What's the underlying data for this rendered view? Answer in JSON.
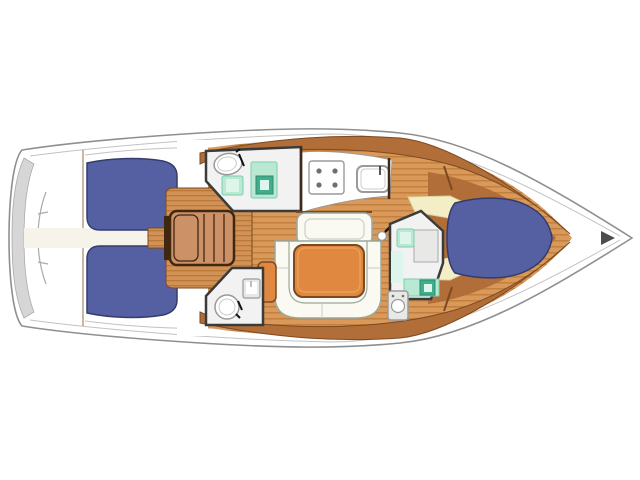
{
  "vessel": {
    "type": "sailing yacht monohull",
    "view": "overhead deck and interior layout plan",
    "orientation": "bow to the right, stern (transom) to the left",
    "background": "plain white, no text or labels rendered"
  },
  "features": [
    {
      "id": "swim-platform",
      "label": "Rounded transom with swim platform steps"
    },
    {
      "id": "cockpit-walkway",
      "label": "Center walkway from transom into cockpit"
    },
    {
      "id": "cockpit-bench-upper",
      "label": "Cockpit bench with blue cushion (upper side)"
    },
    {
      "id": "cockpit-bench-lower",
      "label": "Cockpit bench with blue cushion (lower side)"
    },
    {
      "id": "cockpit-sole",
      "label": "Teak-planked cockpit sole"
    },
    {
      "id": "companionway-steps",
      "label": "Companionway steps down to saloon",
      "treads": 4
    },
    {
      "id": "aft-head-upper",
      "label": "Aft head: toilet, mint sink and shower stall"
    },
    {
      "id": "aft-head-lower",
      "label": "Second aft head: toilet and sink"
    },
    {
      "id": "galley",
      "label": "Galley with stove and sink",
      "burners": 4
    },
    {
      "id": "saloon",
      "label": "Saloon: straight bench, U-shaped settee and wood table"
    },
    {
      "id": "mast-post",
      "label": "Mast compression post beside settee"
    },
    {
      "id": "forward-head",
      "label": "Forward head: mint sink, counter unit and toilet"
    },
    {
      "id": "v-berth",
      "label": "Forward cabin V-berth with blue mattress"
    },
    {
      "id": "bow-fitting",
      "label": "Bow anchor fitting (dark triangle at stem)"
    }
  ],
  "colors": {
    "white": "#ffffff",
    "hull_stroke": "#8f8f8f",
    "sheer_line": "#c2c2c2",
    "transom_gray": "#d6d6d6",
    "transom_line": "#aaaaaa",
    "cushion_blue": "#5560a3",
    "cushion_blue_dark": "#343c6b",
    "plank_base": "#d9995b",
    "plank_line": "#c2803c",
    "teak_base": "#d29257",
    "teak_line": "#b97a38",
    "wood_band": "#b26e38",
    "wood_band_edge": "#7c4a22",
    "wood_dark_line": "#3f2a16",
    "steps_fill": "#cd9168",
    "steps_edge": "#40270f",
    "room_floor": "#f2f2f2",
    "room_wall": "#3b3b3b",
    "mint": "#b9e9d3",
    "mint_edge": "#7ccdb0",
    "mint_dark": "#3fae8c",
    "mint_dark_edge": "#2e8a6d",
    "mint_light": "#ddf5ea",
    "cream": "#f4eec6",
    "cream_edge": "#ddd3a0",
    "settee_fill": "#fbfaf2",
    "settee_edge": "#9aa89e",
    "settee_inner": "#c9cfc4",
    "table_fill": "#e0883f",
    "table_edge": "#7a4a22",
    "fixture_white": "#ffffff",
    "fixture_gray": "#9a9a9a",
    "fixture_light": "#e8e8e6",
    "burner": "#6f6f6f",
    "walkway": "#f6f3ea",
    "black": "#111111",
    "bow_fitting": "#4c4c4c"
  }
}
